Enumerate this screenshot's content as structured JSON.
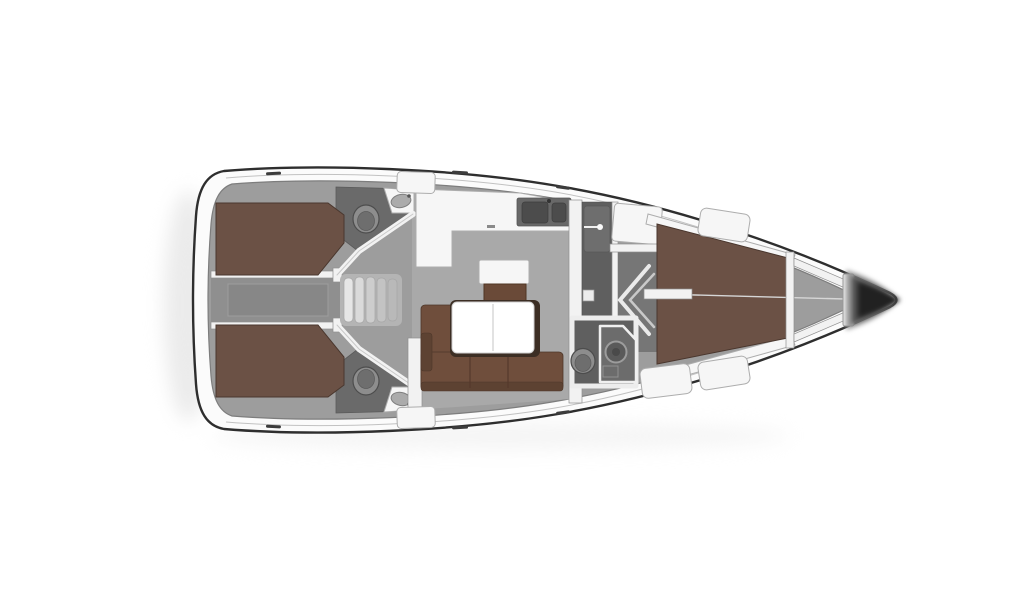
{
  "meta": {
    "description": "Top-view interior layout plan of a sailing yacht, bow pointing right",
    "width": 1024,
    "height": 600
  },
  "scene": {
    "type": "yacht-floor-plan",
    "orientation": "bow-right",
    "areas": [
      {
        "name": "aft-cabin-port",
        "furniture": [
          "double-berth"
        ]
      },
      {
        "name": "aft-cabin-starboard",
        "furniture": [
          "double-berth"
        ]
      },
      {
        "name": "companionway",
        "furniture": [
          "steps",
          "engine-hatch"
        ]
      },
      {
        "name": "aft-head-port",
        "fixtures": [
          "toilet",
          "washbasin"
        ]
      },
      {
        "name": "aft-head-starboard",
        "fixtures": [
          "toilet",
          "washbasin"
        ]
      },
      {
        "name": "galley",
        "fixtures": [
          "l-shaped-counter",
          "double-sink"
        ]
      },
      {
        "name": "salon",
        "furniture": [
          "l-sofa",
          "table",
          "cabinet"
        ]
      },
      {
        "name": "mid-corridor",
        "furniture": [
          "locker-doors",
          "wardrobe"
        ]
      },
      {
        "name": "forward-head",
        "fixtures": [
          "toilet",
          "shower"
        ]
      },
      {
        "name": "forward-cabin",
        "furniture": [
          "v-berth",
          "side-shelves",
          "seat-lockers"
        ]
      },
      {
        "name": "anchor-locker",
        "fixtures": [
          "bow-frame"
        ]
      }
    ]
  },
  "colors": {
    "background": "#ffffff",
    "hull_fill": "#fbfbfb",
    "hull_stroke": "#2e2e2e",
    "deck_line": "#c2c2c2",
    "floor_base": "#9d9d9d",
    "floor_edge": "#7d7d7d",
    "floor_salon": "#a9a9a9",
    "floor_dark": "#6a6a6a",
    "corridor": "#8f8f8f",
    "corridor_dark": "#767676",
    "engine_hatch": "#878787",
    "steps_light": "#b4b4b4",
    "berth_brown": "#6b5145",
    "berth_stroke": "#4a372e",
    "sofa_brown": "#6f4e3c",
    "sofa_dark": "#5d4232",
    "sofa_stroke": "#4e372a",
    "table_frame": "#3c2e24",
    "table_top": "#ffffff",
    "white_furniture": "#f6f6f6",
    "furniture_stroke": "#adadad",
    "wall_white": "#f2f2f2",
    "wall_stroke": "#8f8f8f",
    "sink_counter": "#686868",
    "sink_basin": "#4c4c4c",
    "fixture_light": "#8d8d8d",
    "fixture_mid": "#6e6e6e",
    "fixture_stroke": "#4d4d4d",
    "seam_line": "#d6d6d6",
    "tick_dark": "#3c3c3c",
    "bow_light": "#8f8f8f",
    "bow_mid": "#4f4f4f",
    "bow_dark": "#212121",
    "shadow": "#e7e7e7"
  }
}
